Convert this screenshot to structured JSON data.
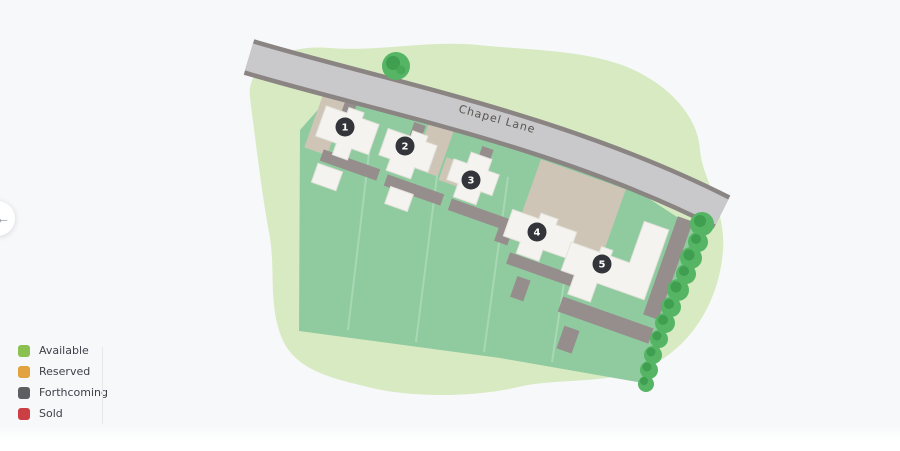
{
  "page": {
    "background": "#F7F8FA"
  },
  "carousel": {
    "prev_icon": "←"
  },
  "road": {
    "label": "Chapel Lane",
    "fill": "#C9C9CB",
    "border": "#8A8583"
  },
  "site_colors": {
    "plot_green": "#90CBA0",
    "surround_green": "#D8EAC2",
    "house": "#F4F3EF",
    "driveway": "#CFC5B7",
    "footpath": "#968E8C",
    "tree": "#55B564"
  },
  "plots": [
    {
      "number": "1",
      "status": "Forthcoming",
      "badge_color": "#33353A"
    },
    {
      "number": "2",
      "status": "Forthcoming",
      "badge_color": "#33353A"
    },
    {
      "number": "3",
      "status": "Forthcoming",
      "badge_color": "#33353A"
    },
    {
      "number": "4",
      "status": "Forthcoming",
      "badge_color": "#33353A"
    },
    {
      "number": "5",
      "status": "Forthcoming",
      "badge_color": "#33353A"
    }
  ],
  "legend": {
    "items": [
      {
        "label": "Available",
        "color": "#8CC152"
      },
      {
        "label": "Reserved",
        "color": "#E2A23E"
      },
      {
        "label": "Forthcoming",
        "color": "#5E5E62"
      },
      {
        "label": "Sold",
        "color": "#CB3E44"
      }
    ]
  }
}
